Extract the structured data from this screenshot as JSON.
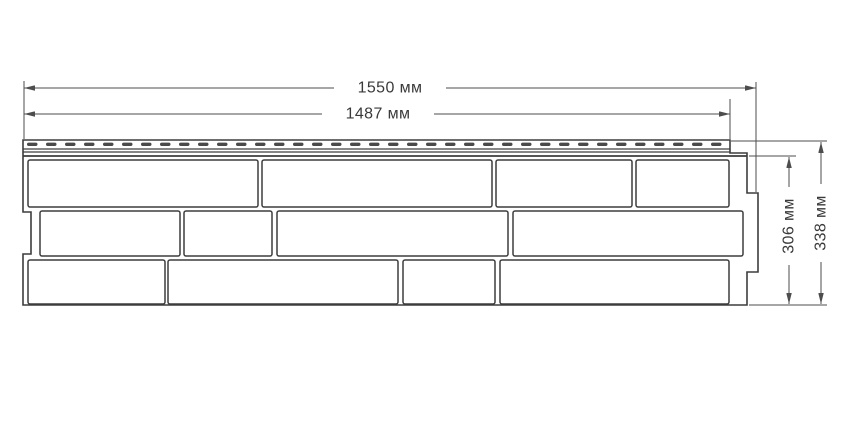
{
  "dimensions": {
    "total_width": "1550 мм",
    "nail_strip_width": "1487 мм",
    "panel_height": "306 мм",
    "total_height": "338 мм"
  },
  "nail_strip": {
    "perforation_count": 37
  },
  "bricks": {
    "rows": 3,
    "bricks_per_row": 4
  },
  "colors": {
    "background": "#ffffff",
    "outline": "#3d3d3d",
    "dimension_line": "#4d4d4d",
    "perforation": "#4a4a4a",
    "text": "#3a3a3a"
  }
}
